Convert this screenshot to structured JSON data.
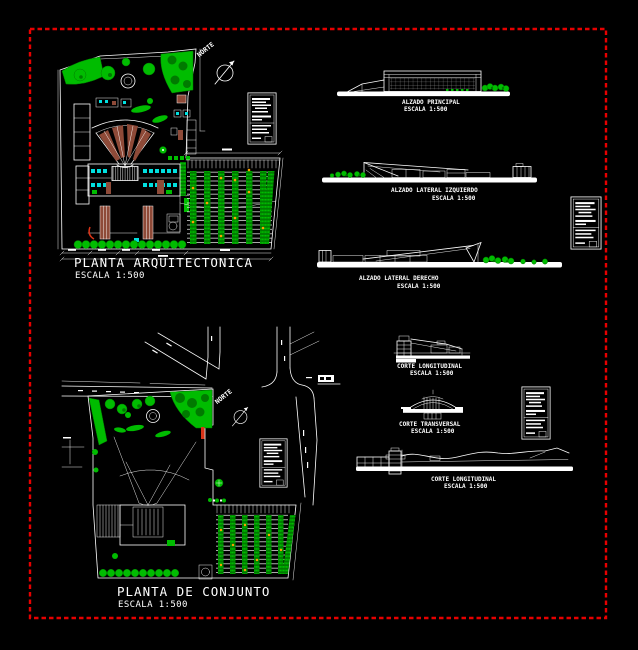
{
  "colors": {
    "background": "#000000",
    "frame": "#e60000",
    "line": "#ffffff",
    "vegetation": "#00bc00",
    "vegetation_dark": "#007a00",
    "seating": "#8e4a38",
    "cyan": "#00e0e0",
    "orange": "#ffa000",
    "red": "#d93418"
  },
  "panels": {
    "planta_arquitectonica": {
      "title": "PLANTA ARQUITECTONICA",
      "scale": "ESCALA 1:500",
      "north": "NORTE"
    },
    "planta_de_conjunto": {
      "title": "PLANTA DE CONJUNTO",
      "scale": "ESCALA 1:500",
      "north": "NORTE"
    },
    "alzado_principal": {
      "title": "ALZADO PRINCIPAL",
      "scale": "ESCALA 1:500"
    },
    "alzado_lateral_izquierdo": {
      "title": "ALZADO LATERAL IZQUIERDO",
      "scale": "ESCALA 1:500"
    },
    "alzado_lateral_derecho": {
      "title": "ALZADO LATERAL DERECHO",
      "scale": "ESCALA 1:500"
    },
    "corte_longitudinal_superior": {
      "title": "CORTE LONGITUDINAL",
      "scale": "ESCALA 1:500"
    },
    "corte_transversal": {
      "title": "CORTE TRANSVERSAL",
      "scale": "ESCALA 1:500"
    },
    "corte_longitudinal_inferior": {
      "title": "CORTE LONGITUDINAL",
      "scale": "ESCALA 1:500"
    }
  }
}
